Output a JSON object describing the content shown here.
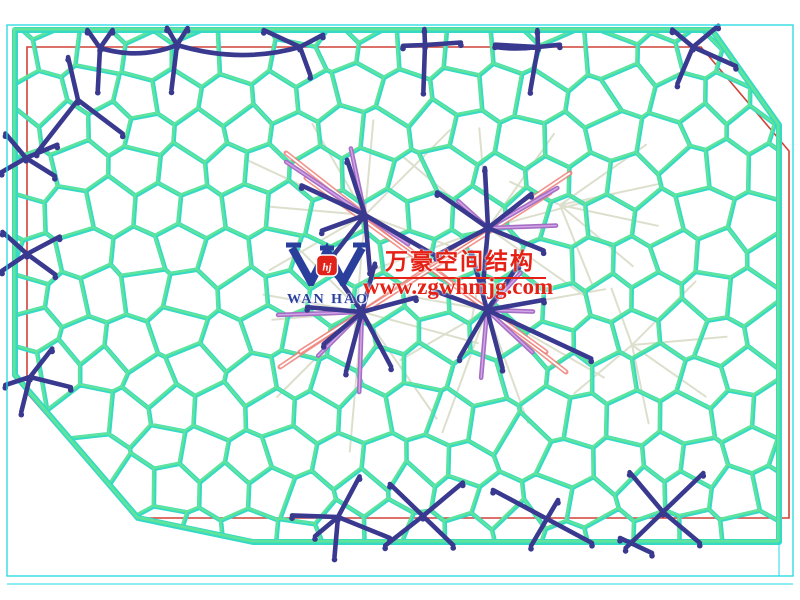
{
  "watermark": {
    "company_cn": "万豪空间结构",
    "url": "www.zgwhmjg.com",
    "logo_text": "WAN HAO",
    "logo_monogram": "hj"
  },
  "drawing": {
    "palette": {
      "background": "#ffffff",
      "border_cyan": "#1fd9e2",
      "mesh_cyan": "#35d9c5",
      "mesh_green": "#5fe49a",
      "red": "#cf4237",
      "pink": "#ef8078",
      "purple": "#a76fc4",
      "purple_light": "#d2a6e8",
      "blue": "#39398f",
      "gray": "#d9dbc8",
      "wm_red": "#e52015",
      "logo_blue": "#2a3e9b",
      "logo_red": "#e0231b"
    },
    "border": {
      "x": 7,
      "y": 25,
      "w": 786,
      "h": 551,
      "second_line_y": 584,
      "tick_x": 779,
      "tick_y1": 542,
      "tick_y2": 576
    },
    "outline_mesh": [
      [
        15,
        30
      ],
      [
        712,
        30
      ],
      [
        779,
        125
      ],
      [
        779,
        542
      ],
      [
        253,
        542
      ],
      [
        138,
        518
      ],
      [
        15,
        375
      ]
    ],
    "outline_red": [
      [
        27,
        47
      ],
      [
        701,
        47
      ],
      [
        789,
        151
      ],
      [
        789,
        518
      ],
      [
        137,
        518
      ],
      [
        27,
        393
      ]
    ],
    "voronoi": {
      "seed": 1337,
      "sx": 46,
      "sy": 40,
      "jitter": 11,
      "margin": 16
    },
    "stars": [
      {
        "x": 78,
        "y": 100,
        "arms": [
          [
            -103,
            44
          ],
          [
            128,
            67
          ],
          [
            37,
            56
          ]
        ]
      },
      {
        "x": 100,
        "y": 48,
        "arms": [
          [
            -125,
            22
          ],
          [
            -55,
            22
          ],
          [
            93,
            42
          ]
        ]
      },
      {
        "x": 177,
        "y": 45,
        "arms": [
          [
            -120,
            20
          ],
          [
            -58,
            20
          ],
          [
            97,
            45
          ]
        ]
      },
      {
        "x": 300,
        "y": 47,
        "arms": [
          [
            -155,
            40
          ],
          [
            -28,
            26
          ],
          [
            70,
            30
          ]
        ]
      },
      {
        "x": 425,
        "y": 45,
        "arms": [
          [
            178,
            22
          ],
          [
            -4,
            36
          ],
          [
            -92,
            16
          ],
          [
            92,
            46
          ]
        ]
      },
      {
        "x": 538,
        "y": 47,
        "arms": [
          [
            -92,
            17
          ],
          [
            -6,
            22
          ],
          [
            100,
            44
          ],
          [
            183,
            43
          ]
        ]
      },
      {
        "x": 693,
        "y": 47,
        "arms": [
          [
            -140,
            27
          ],
          [
            -40,
            33
          ],
          [
            24,
            47
          ],
          [
            113,
            40
          ]
        ]
      },
      {
        "x": 26,
        "y": 158,
        "arms": [
          [
            -130,
            32
          ],
          [
            -23,
            34
          ],
          [
            150,
            28
          ],
          [
            32,
            34
          ]
        ]
      },
      {
        "x": 27,
        "y": 254,
        "arms": [
          [
            -138,
            33
          ],
          [
            -28,
            37
          ],
          [
            146,
            30
          ],
          [
            36,
            35
          ]
        ]
      },
      {
        "x": 30,
        "y": 377,
        "arms": [
          [
            -52,
            36
          ],
          [
            14,
            42
          ],
          [
            104,
            36
          ],
          [
            162,
            26
          ]
        ]
      },
      {
        "x": 365,
        "y": 215,
        "arms": [
          [
            205,
            70
          ],
          [
            252,
            58
          ],
          [
            160,
            46
          ],
          [
            30,
            82
          ],
          [
            85,
            56
          ],
          [
            128,
            50
          ]
        ]
      },
      {
        "x": 488,
        "y": 228,
        "arms": [
          [
            215,
            62
          ],
          [
            267,
            60
          ],
          [
            322,
            55
          ],
          [
            22,
            60
          ],
          [
            95,
            52
          ],
          [
            152,
            55
          ]
        ]
      },
      {
        "x": 362,
        "y": 312,
        "arms": [
          [
            185,
            55
          ],
          [
            235,
            56
          ],
          [
            285,
            50
          ],
          [
            345,
            56
          ],
          [
            62,
            62
          ],
          [
            105,
            62
          ],
          [
            140,
            50
          ]
        ]
      },
      {
        "x": 487,
        "y": 310,
        "arms": [
          [
            200,
            56
          ],
          [
            255,
            60
          ],
          [
            305,
            55
          ],
          [
            350,
            58
          ],
          [
            25,
            115
          ],
          [
            75,
            60
          ],
          [
            120,
            55
          ]
        ]
      },
      {
        "x": 338,
        "y": 517,
        "arms": [
          [
            182,
            46
          ],
          [
            95,
            40
          ],
          [
            22,
            56
          ],
          [
            -62,
            46
          ],
          [
            140,
            30
          ]
        ]
      },
      {
        "x": 423,
        "y": 516,
        "arms": [
          [
            -136,
            46
          ],
          [
            -40,
            52
          ],
          [
            44,
            42
          ],
          [
            142,
            48
          ]
        ]
      },
      {
        "x": 663,
        "y": 512,
        "arms": [
          [
            -130,
            52
          ],
          [
            -44,
            56
          ],
          [
            40,
            48
          ],
          [
            136,
            52
          ]
        ]
      }
    ],
    "blue_segments": [
      [
        493,
        490,
        592,
        543
      ],
      [
        558,
        500,
        531,
        546
      ],
      [
        620,
        538,
        652,
        553
      ]
    ],
    "blue_chords": [
      [
        100,
        48,
        140,
        60,
        177,
        45
      ],
      [
        177,
        45,
        240,
        64,
        300,
        47
      ],
      [
        495,
        47,
        516,
        50,
        538,
        47
      ]
    ],
    "purple_stars": [
      {
        "x": 365,
        "y": 215,
        "arms": [
          [
            214,
            95
          ],
          [
            258,
            68
          ],
          [
            34,
            52
          ]
        ]
      },
      {
        "x": 488,
        "y": 228,
        "arms": [
          [
            -30,
            80
          ],
          [
            -2,
            68
          ],
          [
            222,
            40
          ]
        ]
      },
      {
        "x": 362,
        "y": 312,
        "arms": [
          [
            178,
            84
          ],
          [
            92,
            80
          ],
          [
            135,
            62
          ]
        ]
      },
      {
        "x": 487,
        "y": 310,
        "arms": [
          [
            2,
            46
          ],
          [
            43,
            62
          ],
          [
            -48,
            50
          ],
          [
            95,
            68
          ]
        ]
      }
    ],
    "gray_fans": [
      {
        "x": 365,
        "y": 215,
        "rays": [
          [
            -155,
            130
          ],
          [
            -120,
            105
          ],
          [
            -85,
            95
          ],
          [
            -45,
            120
          ],
          [
            20,
            140
          ],
          [
            95,
            120
          ],
          [
            150,
            110
          ],
          [
            185,
            95
          ]
        ]
      },
      {
        "x": 488,
        "y": 228,
        "rays": [
          [
            -140,
            110
          ],
          [
            -95,
            100
          ],
          [
            -55,
            115
          ],
          [
            -15,
            130
          ],
          [
            35,
            120
          ],
          [
            100,
            110
          ],
          [
            160,
            120
          ]
        ]
      },
      {
        "x": 362,
        "y": 312,
        "rays": [
          [
            -170,
            100
          ],
          [
            -135,
            90
          ],
          [
            135,
            120
          ],
          [
            95,
            140
          ],
          [
            55,
            130
          ],
          [
            15,
            120
          ],
          [
            175,
            90
          ]
        ]
      },
      {
        "x": 487,
        "y": 310,
        "rays": [
          [
            -10,
            120
          ],
          [
            30,
            135
          ],
          [
            70,
            120
          ],
          [
            110,
            130
          ],
          [
            150,
            100
          ],
          [
            -170,
            80
          ]
        ]
      },
      {
        "x": 560,
        "y": 205,
        "rays": [
          [
            -35,
            105
          ],
          [
            -12,
            100
          ],
          [
            12,
            100
          ],
          [
            40,
            95
          ],
          [
            68,
            85
          ],
          [
            205,
            55
          ]
        ]
      },
      {
        "x": 632,
        "y": 345,
        "rays": [
          [
            -45,
            90
          ],
          [
            -5,
            95
          ],
          [
            35,
            90
          ],
          [
            78,
            80
          ],
          [
            140,
            75
          ],
          [
            250,
            60
          ]
        ]
      }
    ],
    "pink_segments": [
      [
        286,
        153,
        566,
        372
      ],
      [
        570,
        173,
        280,
        367
      ],
      [
        306,
        178,
        546,
        352
      ],
      [
        550,
        193,
        300,
        352
      ]
    ]
  }
}
